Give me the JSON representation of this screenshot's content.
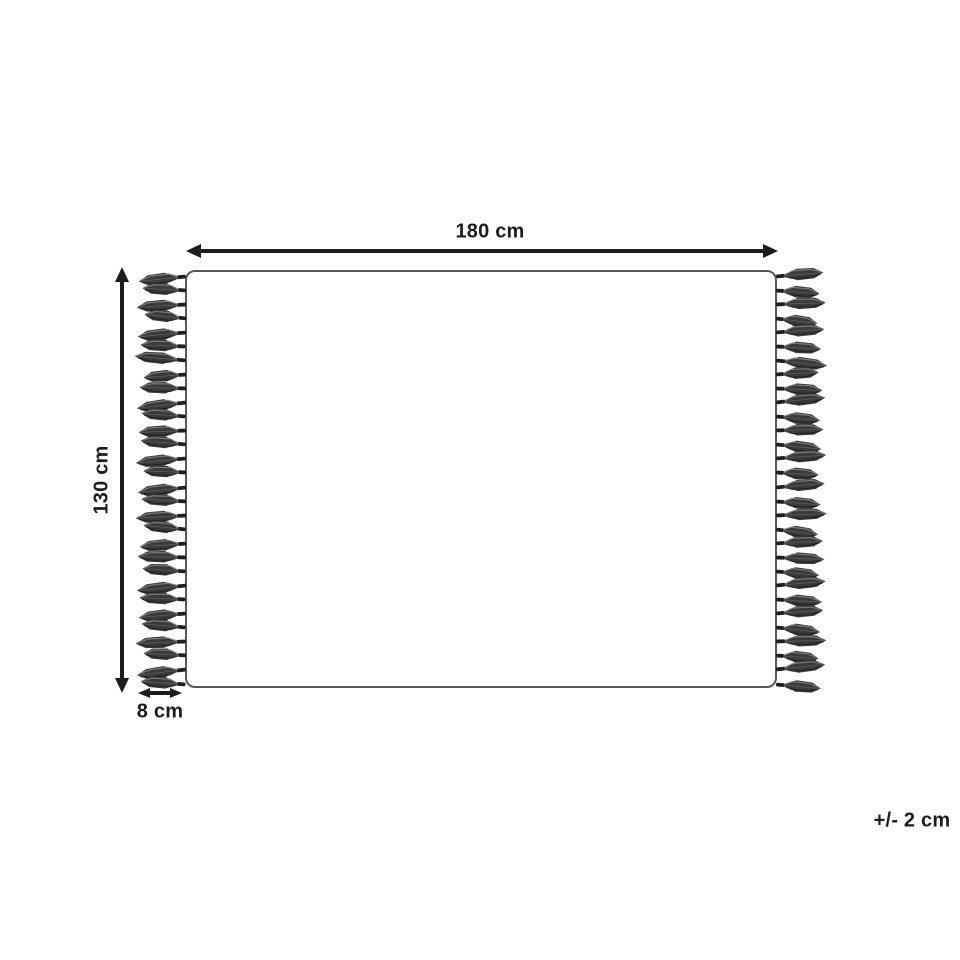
{
  "labels": {
    "width": "180 cm",
    "height": "130 cm",
    "fringe_width": "8 cm",
    "tolerance": "+/- 2 cm"
  },
  "fringe": {
    "left_count": 30,
    "right_count": 30
  },
  "colors": {
    "background": "#ffffff",
    "ink": "#1c1c1a",
    "outline": "#57585a",
    "tassel_base": "#3a3a3c",
    "tassel_dark": "#1f1f21",
    "tassel_light": "#828284"
  }
}
